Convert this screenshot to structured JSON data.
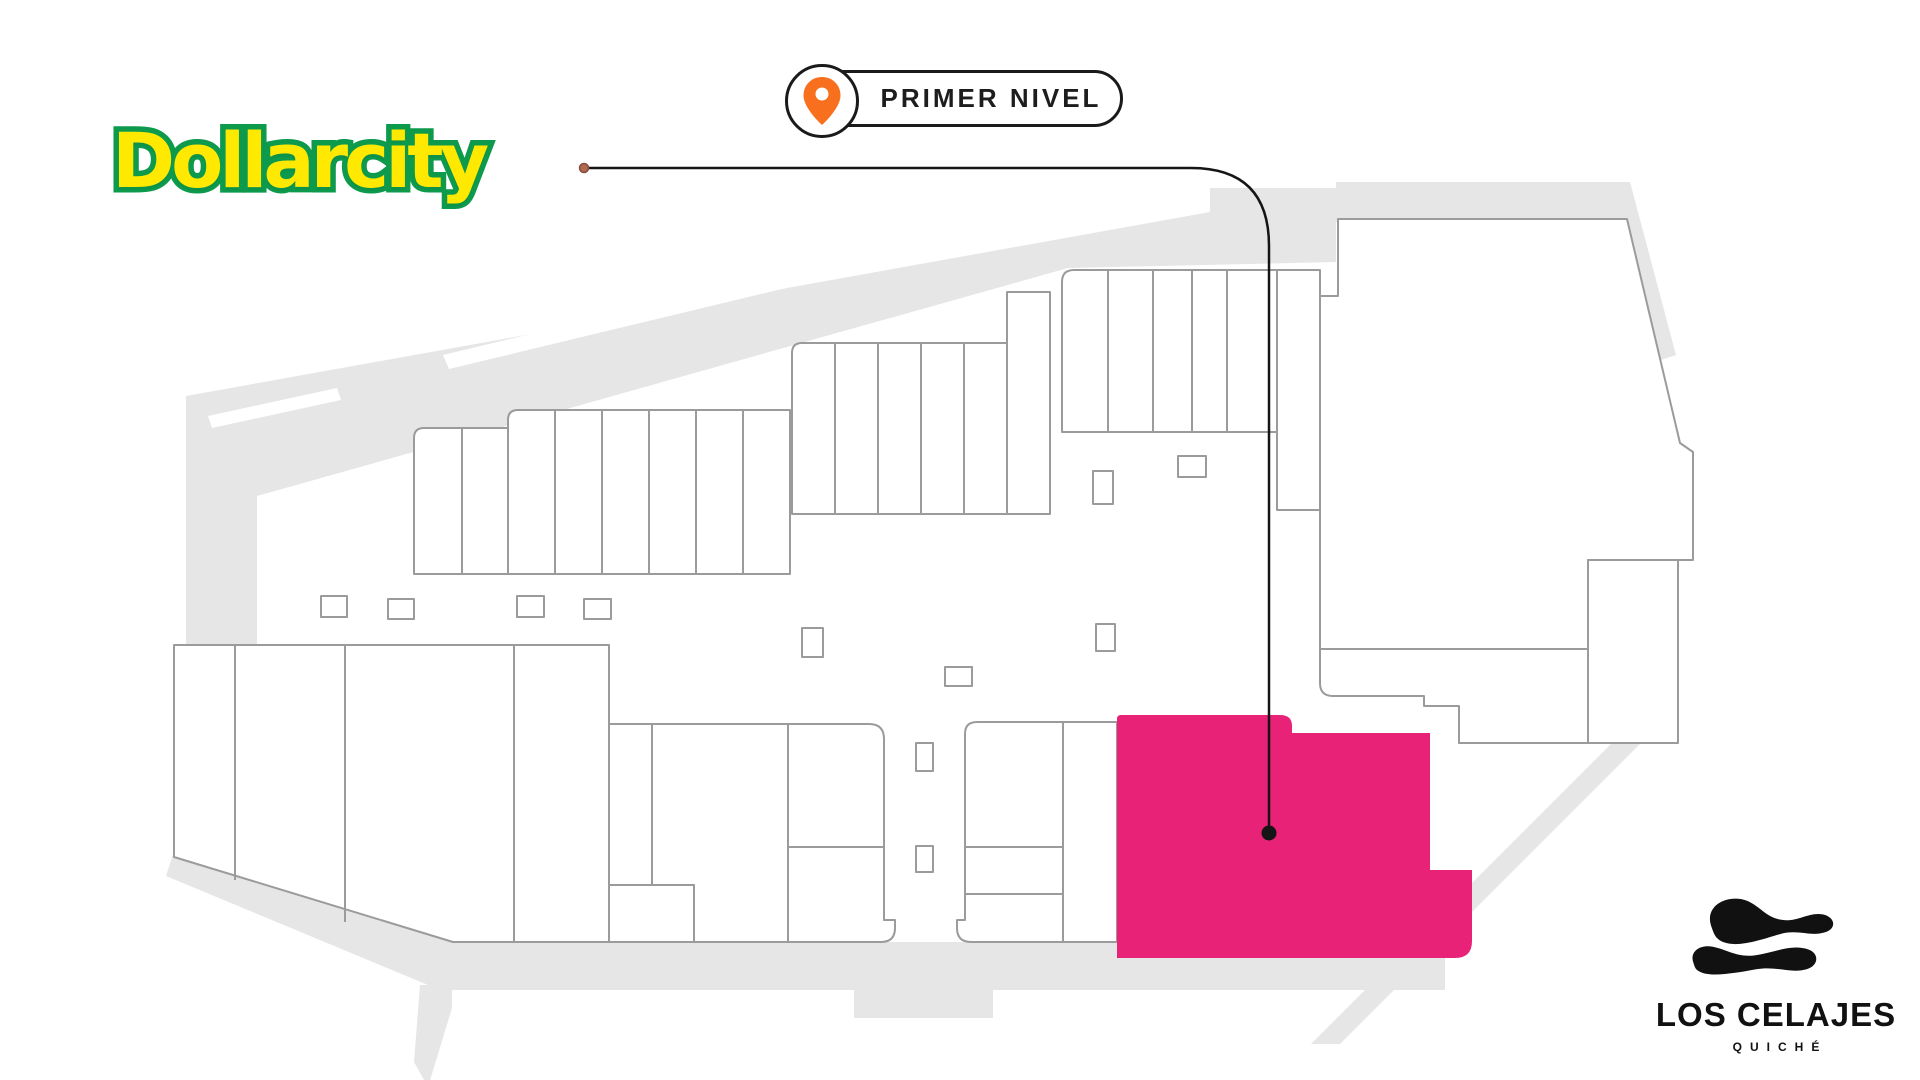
{
  "branding": {
    "store_logo_text": "Dollarcity",
    "logo_fill_color": "#ffe900",
    "logo_outline_color": "#0d9a4d"
  },
  "level_badge": {
    "label": "PRIMER NIVEL",
    "icon": "location-pin-icon",
    "pin_color": "#f8701d",
    "outline_color": "#1a1a1a"
  },
  "mall_logo": {
    "name": "LOS CELAJES",
    "subtitle": "QUICHÉ",
    "icon": "clouds-logo-icon",
    "color": "#111111"
  },
  "floor_map": {
    "level_shown": "PRIMER NIVEL",
    "highlighted_store": "Dollarcity",
    "highlight_color": "#e82277",
    "walkway_color": "#e6e6e6",
    "store_fill_color": "#ffffff",
    "store_outline_color": "#9b9b9b",
    "callout_line_color": "#151515",
    "callout_start_dot_color": "#b06a52"
  }
}
